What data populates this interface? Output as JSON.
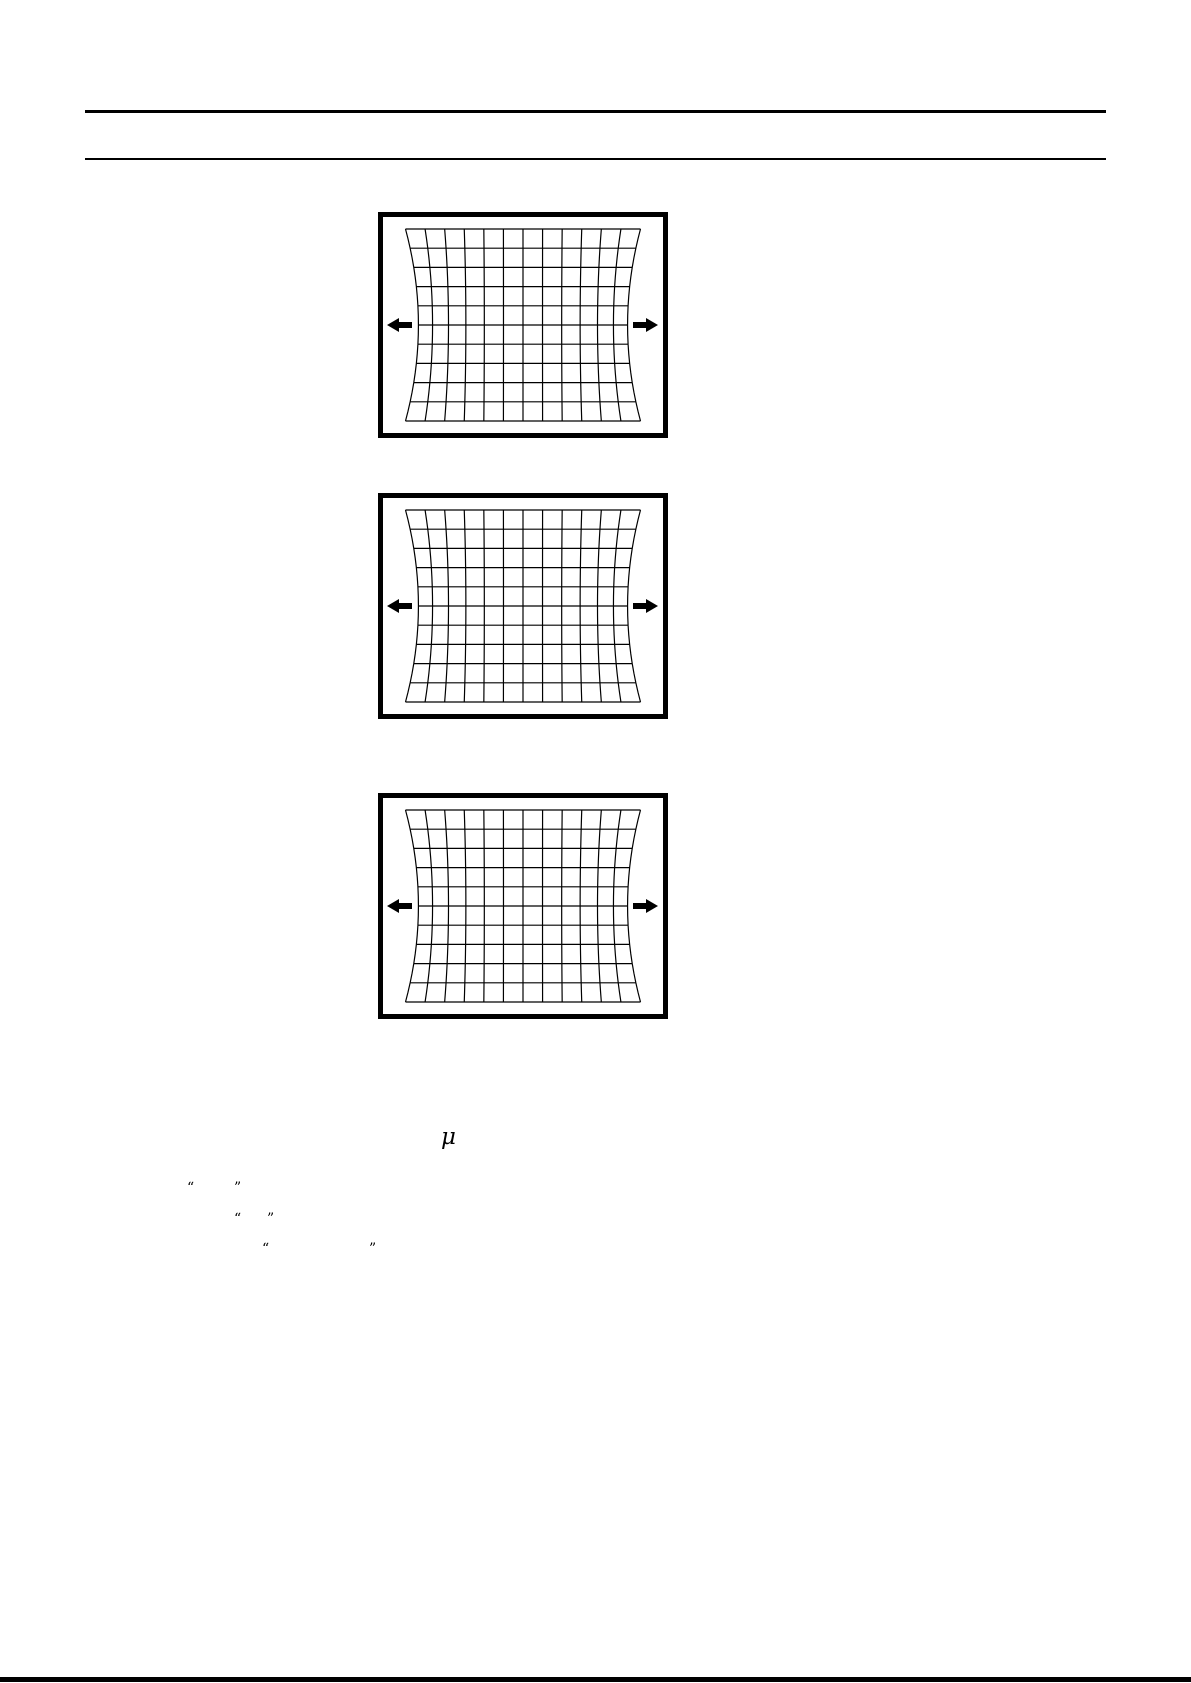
{
  "page": {
    "background_color": "#ffffff",
    "ink_color": "#000000"
  },
  "figures": [
    {
      "grid": {
        "columns": 12,
        "rows": 10,
        "distortion": "left-right-edges-pinched-inward",
        "pinch_ratio": 0.11
      },
      "arrows": [
        {
          "direction": "left"
        },
        {
          "direction": "right"
        }
      ]
    },
    {
      "grid": {
        "columns": 12,
        "rows": 10,
        "distortion": "left-right-edges-pinched-inward",
        "pinch_ratio": 0.11
      },
      "arrows": [
        {
          "direction": "left"
        },
        {
          "direction": "right"
        }
      ]
    },
    {
      "grid": {
        "columns": 12,
        "rows": 10,
        "distortion": "left-right-edges-pinched-inward",
        "pinch_ratio": 0.11
      },
      "arrows": [
        {
          "direction": "left"
        },
        {
          "direction": "right"
        }
      ]
    }
  ],
  "text_fragments": {
    "mu_symbol": "μ",
    "quote_lines": [
      {
        "open_quote": "“",
        "close_quote": "”"
      },
      {
        "open_quote": "“",
        "close_quote": "”"
      },
      {
        "open_quote": "“",
        "close_quote": "”"
      }
    ]
  }
}
